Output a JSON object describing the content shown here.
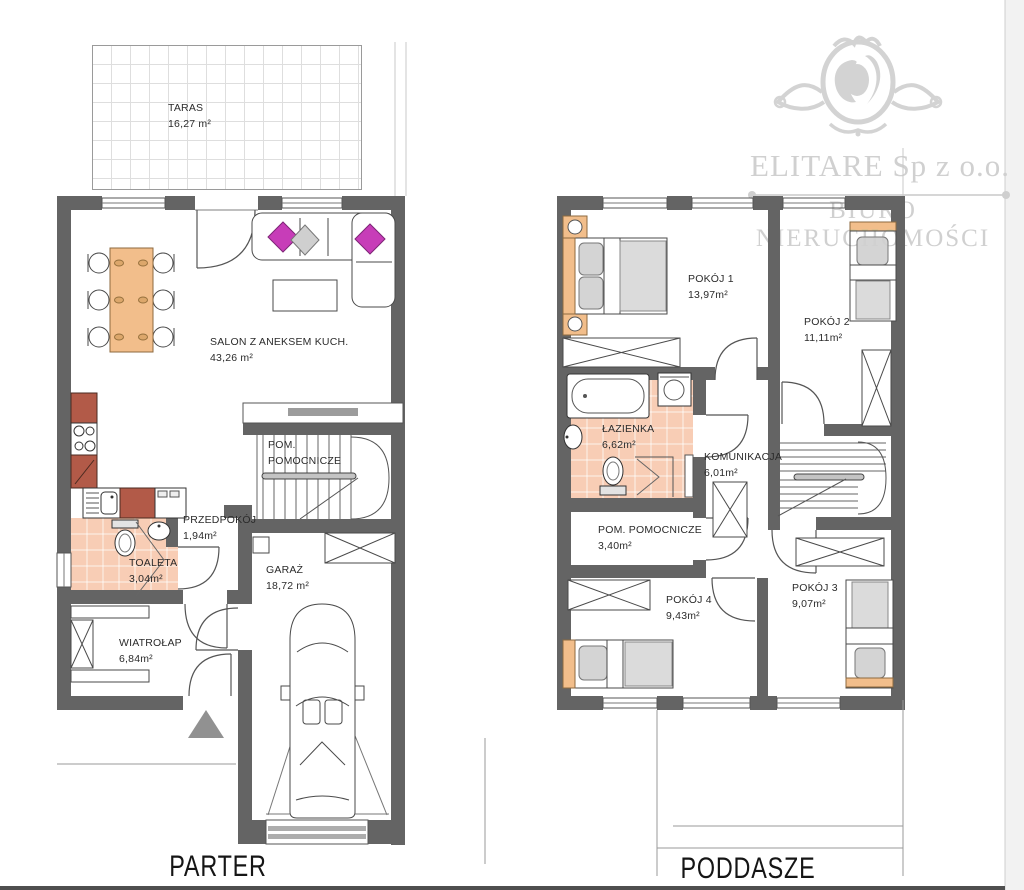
{
  "watermark": {
    "company": "ELITARE Sp z o.o.",
    "subtitle": "BIURO NIERUCHOMOŚCI",
    "logo": "lion-crest"
  },
  "floors": {
    "parter": {
      "title": "PARTER",
      "rooms": [
        {
          "id": "taras",
          "name": "TARAS",
          "area": "16,27 m²"
        },
        {
          "id": "salon",
          "name": "SALON Z ANEKSEM KUCH.",
          "area": "43,26 m²"
        },
        {
          "id": "pom-pomocnicze",
          "name": "POM. POMOCNICZE",
          "area": ""
        },
        {
          "id": "przedpokoj",
          "name": "PRZEDPOKÓJ",
          "area": "1,94m²"
        },
        {
          "id": "toaleta",
          "name": "TOALETA",
          "area": "3,04m²"
        },
        {
          "id": "garaz",
          "name": "GARAŻ",
          "area": "18,72 m²"
        },
        {
          "id": "wiatrolap",
          "name": "WIATROŁAP",
          "area": "6,84m²"
        }
      ]
    },
    "poddasze": {
      "title": "PODDASZE",
      "rooms": [
        {
          "id": "pokoj1",
          "name": "POKÓJ 1",
          "area": "13,97m²"
        },
        {
          "id": "pokoj2",
          "name": "POKÓJ 2",
          "area": "11,11m²"
        },
        {
          "id": "lazienka",
          "name": "ŁAZIENKA",
          "area": "6,62m²"
        },
        {
          "id": "komunikacja",
          "name": "KOMUNIKACJA",
          "area": "6,01m²"
        },
        {
          "id": "pom-pomocnicze",
          "name": "POM. POMOCNICZE",
          "area": "3,40m²"
        },
        {
          "id": "pokoj4",
          "name": "POKÓJ 4",
          "area": "9,43m²"
        },
        {
          "id": "pokoj3",
          "name": "POKÓJ 3",
          "area": "9,07m²"
        }
      ]
    }
  },
  "colors": {
    "wall": "#646464",
    "accent_orange": "#f2be8b",
    "kitchen_terracotta": "#b25a48",
    "bath_tile": "#f8cdb5",
    "pillow_magenta": "#c73db8",
    "watermark_gray": "#d0d0d0"
  }
}
